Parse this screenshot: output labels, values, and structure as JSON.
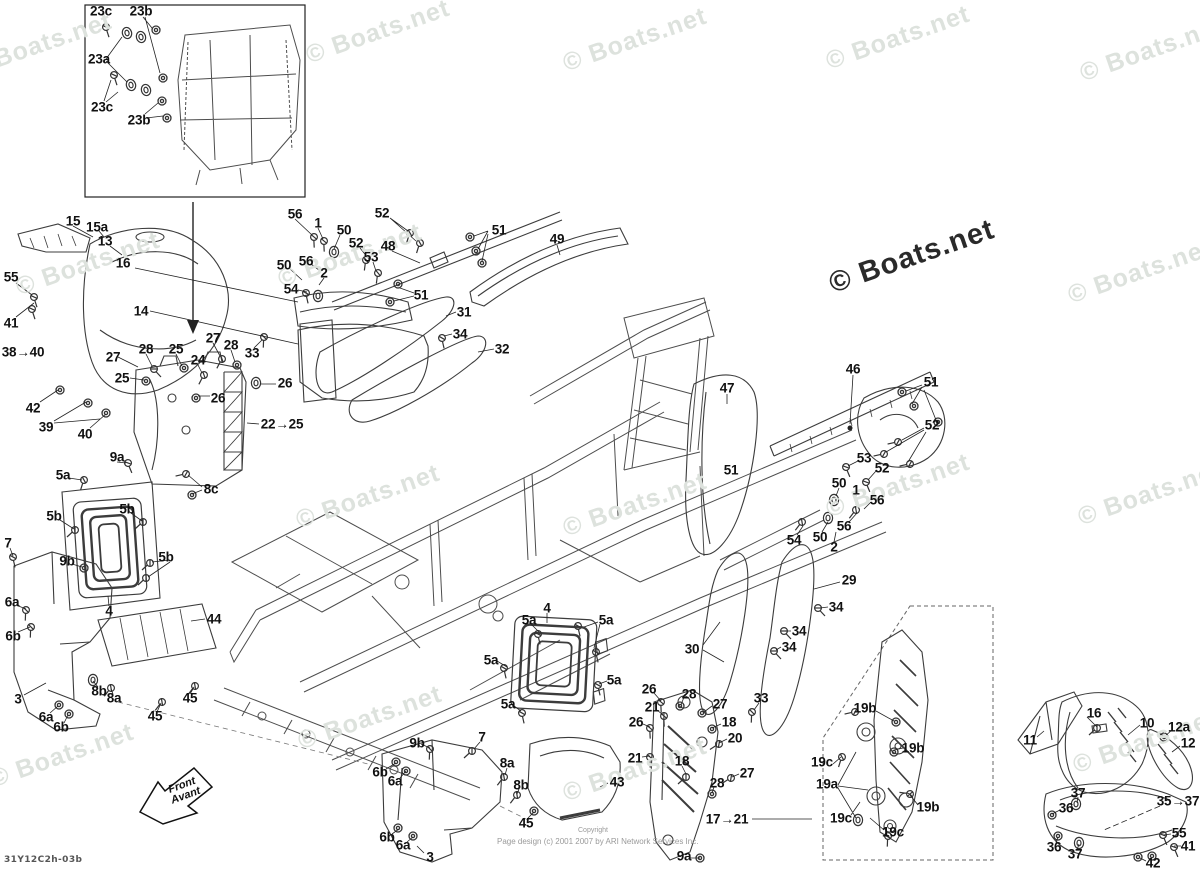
{
  "watermark": {
    "text": "© Boats.net",
    "light_color": "#dde2dd",
    "dark_color": "#2a2a2a"
  },
  "watermark_positions": [
    [
      40,
      45
    ],
    [
      378,
      32
    ],
    [
      635,
      40
    ],
    [
      898,
      38
    ],
    [
      1152,
      50
    ],
    [
      88,
      264
    ],
    [
      350,
      256
    ],
    [
      1140,
      272
    ],
    [
      368,
      497
    ],
    [
      635,
      505
    ],
    [
      898,
      486
    ],
    [
      1150,
      494
    ],
    [
      62,
      756
    ],
    [
      370,
      718
    ],
    [
      635,
      770
    ],
    [
      1145,
      742
    ]
  ],
  "front_arrow": {
    "line1": "Front",
    "line2": "Avant"
  },
  "footer": {
    "drawing_code": "31Y12C2h-03b",
    "copyright_small": "Copyright",
    "copyright_line": "Page design (c) 2001 2007 by ARI Network Services Inc."
  },
  "callouts": [
    {
      "t": "23c",
      "x": 101,
      "y": 11
    },
    {
      "t": "23b",
      "x": 141,
      "y": 11
    },
    {
      "t": "23a",
      "x": 99,
      "y": 59
    },
    {
      "t": "23c",
      "x": 102,
      "y": 107
    },
    {
      "t": "23b",
      "x": 139,
      "y": 120
    },
    {
      "t": "15",
      "x": 73,
      "y": 221
    },
    {
      "t": "15a",
      "x": 97,
      "y": 227
    },
    {
      "t": "13",
      "x": 105,
      "y": 241
    },
    {
      "t": "16",
      "x": 123,
      "y": 263
    },
    {
      "t": "55",
      "x": 11,
      "y": 277
    },
    {
      "t": "14",
      "x": 141,
      "y": 311
    },
    {
      "t": "41",
      "x": 11,
      "y": 323
    },
    {
      "t": "38→40",
      "x": 23,
      "y": 352
    },
    {
      "t": "42",
      "x": 33,
      "y": 408
    },
    {
      "t": "39",
      "x": 46,
      "y": 427
    },
    {
      "t": "40",
      "x": 85,
      "y": 434
    },
    {
      "t": "27",
      "x": 113,
      "y": 357
    },
    {
      "t": "28",
      "x": 146,
      "y": 349
    },
    {
      "t": "25",
      "x": 176,
      "y": 349
    },
    {
      "t": "24",
      "x": 198,
      "y": 360
    },
    {
      "t": "25",
      "x": 122,
      "y": 378
    },
    {
      "t": "27",
      "x": 213,
      "y": 338
    },
    {
      "t": "28",
      "x": 231,
      "y": 345
    },
    {
      "t": "33",
      "x": 252,
      "y": 353
    },
    {
      "t": "26",
      "x": 285,
      "y": 383
    },
    {
      "t": "26",
      "x": 218,
      "y": 398
    },
    {
      "t": "22→25",
      "x": 282,
      "y": 424
    },
    {
      "t": "56",
      "x": 295,
      "y": 214
    },
    {
      "t": "1",
      "x": 318,
      "y": 223
    },
    {
      "t": "50",
      "x": 344,
      "y": 230
    },
    {
      "t": "52",
      "x": 382,
      "y": 213
    },
    {
      "t": "52",
      "x": 356,
      "y": 243
    },
    {
      "t": "48",
      "x": 388,
      "y": 246
    },
    {
      "t": "53",
      "x": 371,
      "y": 257
    },
    {
      "t": "56",
      "x": 306,
      "y": 261
    },
    {
      "t": "50",
      "x": 284,
      "y": 265
    },
    {
      "t": "2",
      "x": 324,
      "y": 273
    },
    {
      "t": "54",
      "x": 291,
      "y": 289
    },
    {
      "t": "51",
      "x": 499,
      "y": 230
    },
    {
      "t": "49",
      "x": 557,
      "y": 239
    },
    {
      "t": "51",
      "x": 421,
      "y": 295
    },
    {
      "t": "31",
      "x": 464,
      "y": 312
    },
    {
      "t": "34",
      "x": 460,
      "y": 334
    },
    {
      "t": "32",
      "x": 502,
      "y": 349
    },
    {
      "t": "47",
      "x": 727,
      "y": 388
    },
    {
      "t": "46",
      "x": 853,
      "y": 369
    },
    {
      "t": "51",
      "x": 931,
      "y": 382
    },
    {
      "t": "52",
      "x": 932,
      "y": 425
    },
    {
      "t": "51",
      "x": 731,
      "y": 470
    },
    {
      "t": "53",
      "x": 864,
      "y": 458
    },
    {
      "t": "52",
      "x": 882,
      "y": 468
    },
    {
      "t": "50",
      "x": 839,
      "y": 483
    },
    {
      "t": "1",
      "x": 856,
      "y": 490
    },
    {
      "t": "56",
      "x": 877,
      "y": 500
    },
    {
      "t": "56",
      "x": 844,
      "y": 526
    },
    {
      "t": "50",
      "x": 820,
      "y": 537
    },
    {
      "t": "2",
      "x": 834,
      "y": 547
    },
    {
      "t": "54",
      "x": 794,
      "y": 540
    },
    {
      "t": "29",
      "x": 849,
      "y": 580
    },
    {
      "t": "34",
      "x": 836,
      "y": 607
    },
    {
      "t": "34",
      "x": 799,
      "y": 631
    },
    {
      "t": "34",
      "x": 789,
      "y": 647
    },
    {
      "t": "30",
      "x": 692,
      "y": 649
    },
    {
      "t": "33",
      "x": 761,
      "y": 698
    },
    {
      "t": "9a",
      "x": 117,
      "y": 457
    },
    {
      "t": "5a",
      "x": 63,
      "y": 475
    },
    {
      "t": "8c",
      "x": 211,
      "y": 489
    },
    {
      "t": "5b",
      "x": 127,
      "y": 509
    },
    {
      "t": "5b",
      "x": 54,
      "y": 516
    },
    {
      "t": "7",
      "x": 8,
      "y": 543
    },
    {
      "t": "9b",
      "x": 67,
      "y": 561
    },
    {
      "t": "5b",
      "x": 166,
      "y": 557
    },
    {
      "t": "6a",
      "x": 12,
      "y": 602
    },
    {
      "t": "4",
      "x": 109,
      "y": 611
    },
    {
      "t": "6b",
      "x": 13,
      "y": 636
    },
    {
      "t": "44",
      "x": 214,
      "y": 619
    },
    {
      "t": "8b",
      "x": 99,
      "y": 691
    },
    {
      "t": "8a",
      "x": 114,
      "y": 698
    },
    {
      "t": "3",
      "x": 18,
      "y": 699
    },
    {
      "t": "45",
      "x": 190,
      "y": 698
    },
    {
      "t": "45",
      "x": 155,
      "y": 716
    },
    {
      "t": "6a",
      "x": 46,
      "y": 717
    },
    {
      "t": "6b",
      "x": 61,
      "y": 727
    },
    {
      "t": "4",
      "x": 547,
      "y": 608
    },
    {
      "t": "5a",
      "x": 529,
      "y": 620
    },
    {
      "t": "5a",
      "x": 606,
      "y": 620
    },
    {
      "t": "5a",
      "x": 491,
      "y": 660
    },
    {
      "t": "5a",
      "x": 614,
      "y": 680
    },
    {
      "t": "5a",
      "x": 508,
      "y": 704
    },
    {
      "t": "26",
      "x": 649,
      "y": 689
    },
    {
      "t": "28",
      "x": 689,
      "y": 694
    },
    {
      "t": "21",
      "x": 652,
      "y": 707
    },
    {
      "t": "27",
      "x": 720,
      "y": 704
    },
    {
      "t": "26",
      "x": 636,
      "y": 722
    },
    {
      "t": "18",
      "x": 729,
      "y": 722
    },
    {
      "t": "20",
      "x": 735,
      "y": 738
    },
    {
      "t": "21",
      "x": 635,
      "y": 758
    },
    {
      "t": "18",
      "x": 682,
      "y": 761
    },
    {
      "t": "27",
      "x": 747,
      "y": 773
    },
    {
      "t": "28",
      "x": 717,
      "y": 783
    },
    {
      "t": "17→21",
      "x": 727,
      "y": 819
    },
    {
      "t": "9a",
      "x": 684,
      "y": 856
    },
    {
      "t": "9b",
      "x": 417,
      "y": 743
    },
    {
      "t": "7",
      "x": 482,
      "y": 737
    },
    {
      "t": "6b",
      "x": 380,
      "y": 772
    },
    {
      "t": "6a",
      "x": 395,
      "y": 781
    },
    {
      "t": "8a",
      "x": 507,
      "y": 763
    },
    {
      "t": "8b",
      "x": 521,
      "y": 785
    },
    {
      "t": "43",
      "x": 617,
      "y": 782
    },
    {
      "t": "45",
      "x": 526,
      "y": 823
    },
    {
      "t": "6b",
      "x": 387,
      "y": 837
    },
    {
      "t": "6a",
      "x": 403,
      "y": 845
    },
    {
      "t": "3",
      "x": 430,
      "y": 857
    },
    {
      "t": "19b",
      "x": 865,
      "y": 708
    },
    {
      "t": "19b",
      "x": 913,
      "y": 748
    },
    {
      "t": "19c",
      "x": 822,
      "y": 762
    },
    {
      "t": "19a",
      "x": 827,
      "y": 784
    },
    {
      "t": "19b",
      "x": 928,
      "y": 807
    },
    {
      "t": "19c",
      "x": 841,
      "y": 818
    },
    {
      "t": "19c",
      "x": 893,
      "y": 832
    },
    {
      "t": "16",
      "x": 1094,
      "y": 713
    },
    {
      "t": "10",
      "x": 1147,
      "y": 723
    },
    {
      "t": "12a",
      "x": 1179,
      "y": 727
    },
    {
      "t": "11",
      "x": 1030,
      "y": 740
    },
    {
      "t": "12",
      "x": 1188,
      "y": 743
    },
    {
      "t": "37",
      "x": 1078,
      "y": 793
    },
    {
      "t": "36",
      "x": 1066,
      "y": 808
    },
    {
      "t": "35→37",
      "x": 1178,
      "y": 801
    },
    {
      "t": "55",
      "x": 1179,
      "y": 833
    },
    {
      "t": "41",
      "x": 1188,
      "y": 846
    },
    {
      "t": "36",
      "x": 1054,
      "y": 847
    },
    {
      "t": "37",
      "x": 1075,
      "y": 854
    },
    {
      "t": "42",
      "x": 1153,
      "y": 863
    }
  ]
}
